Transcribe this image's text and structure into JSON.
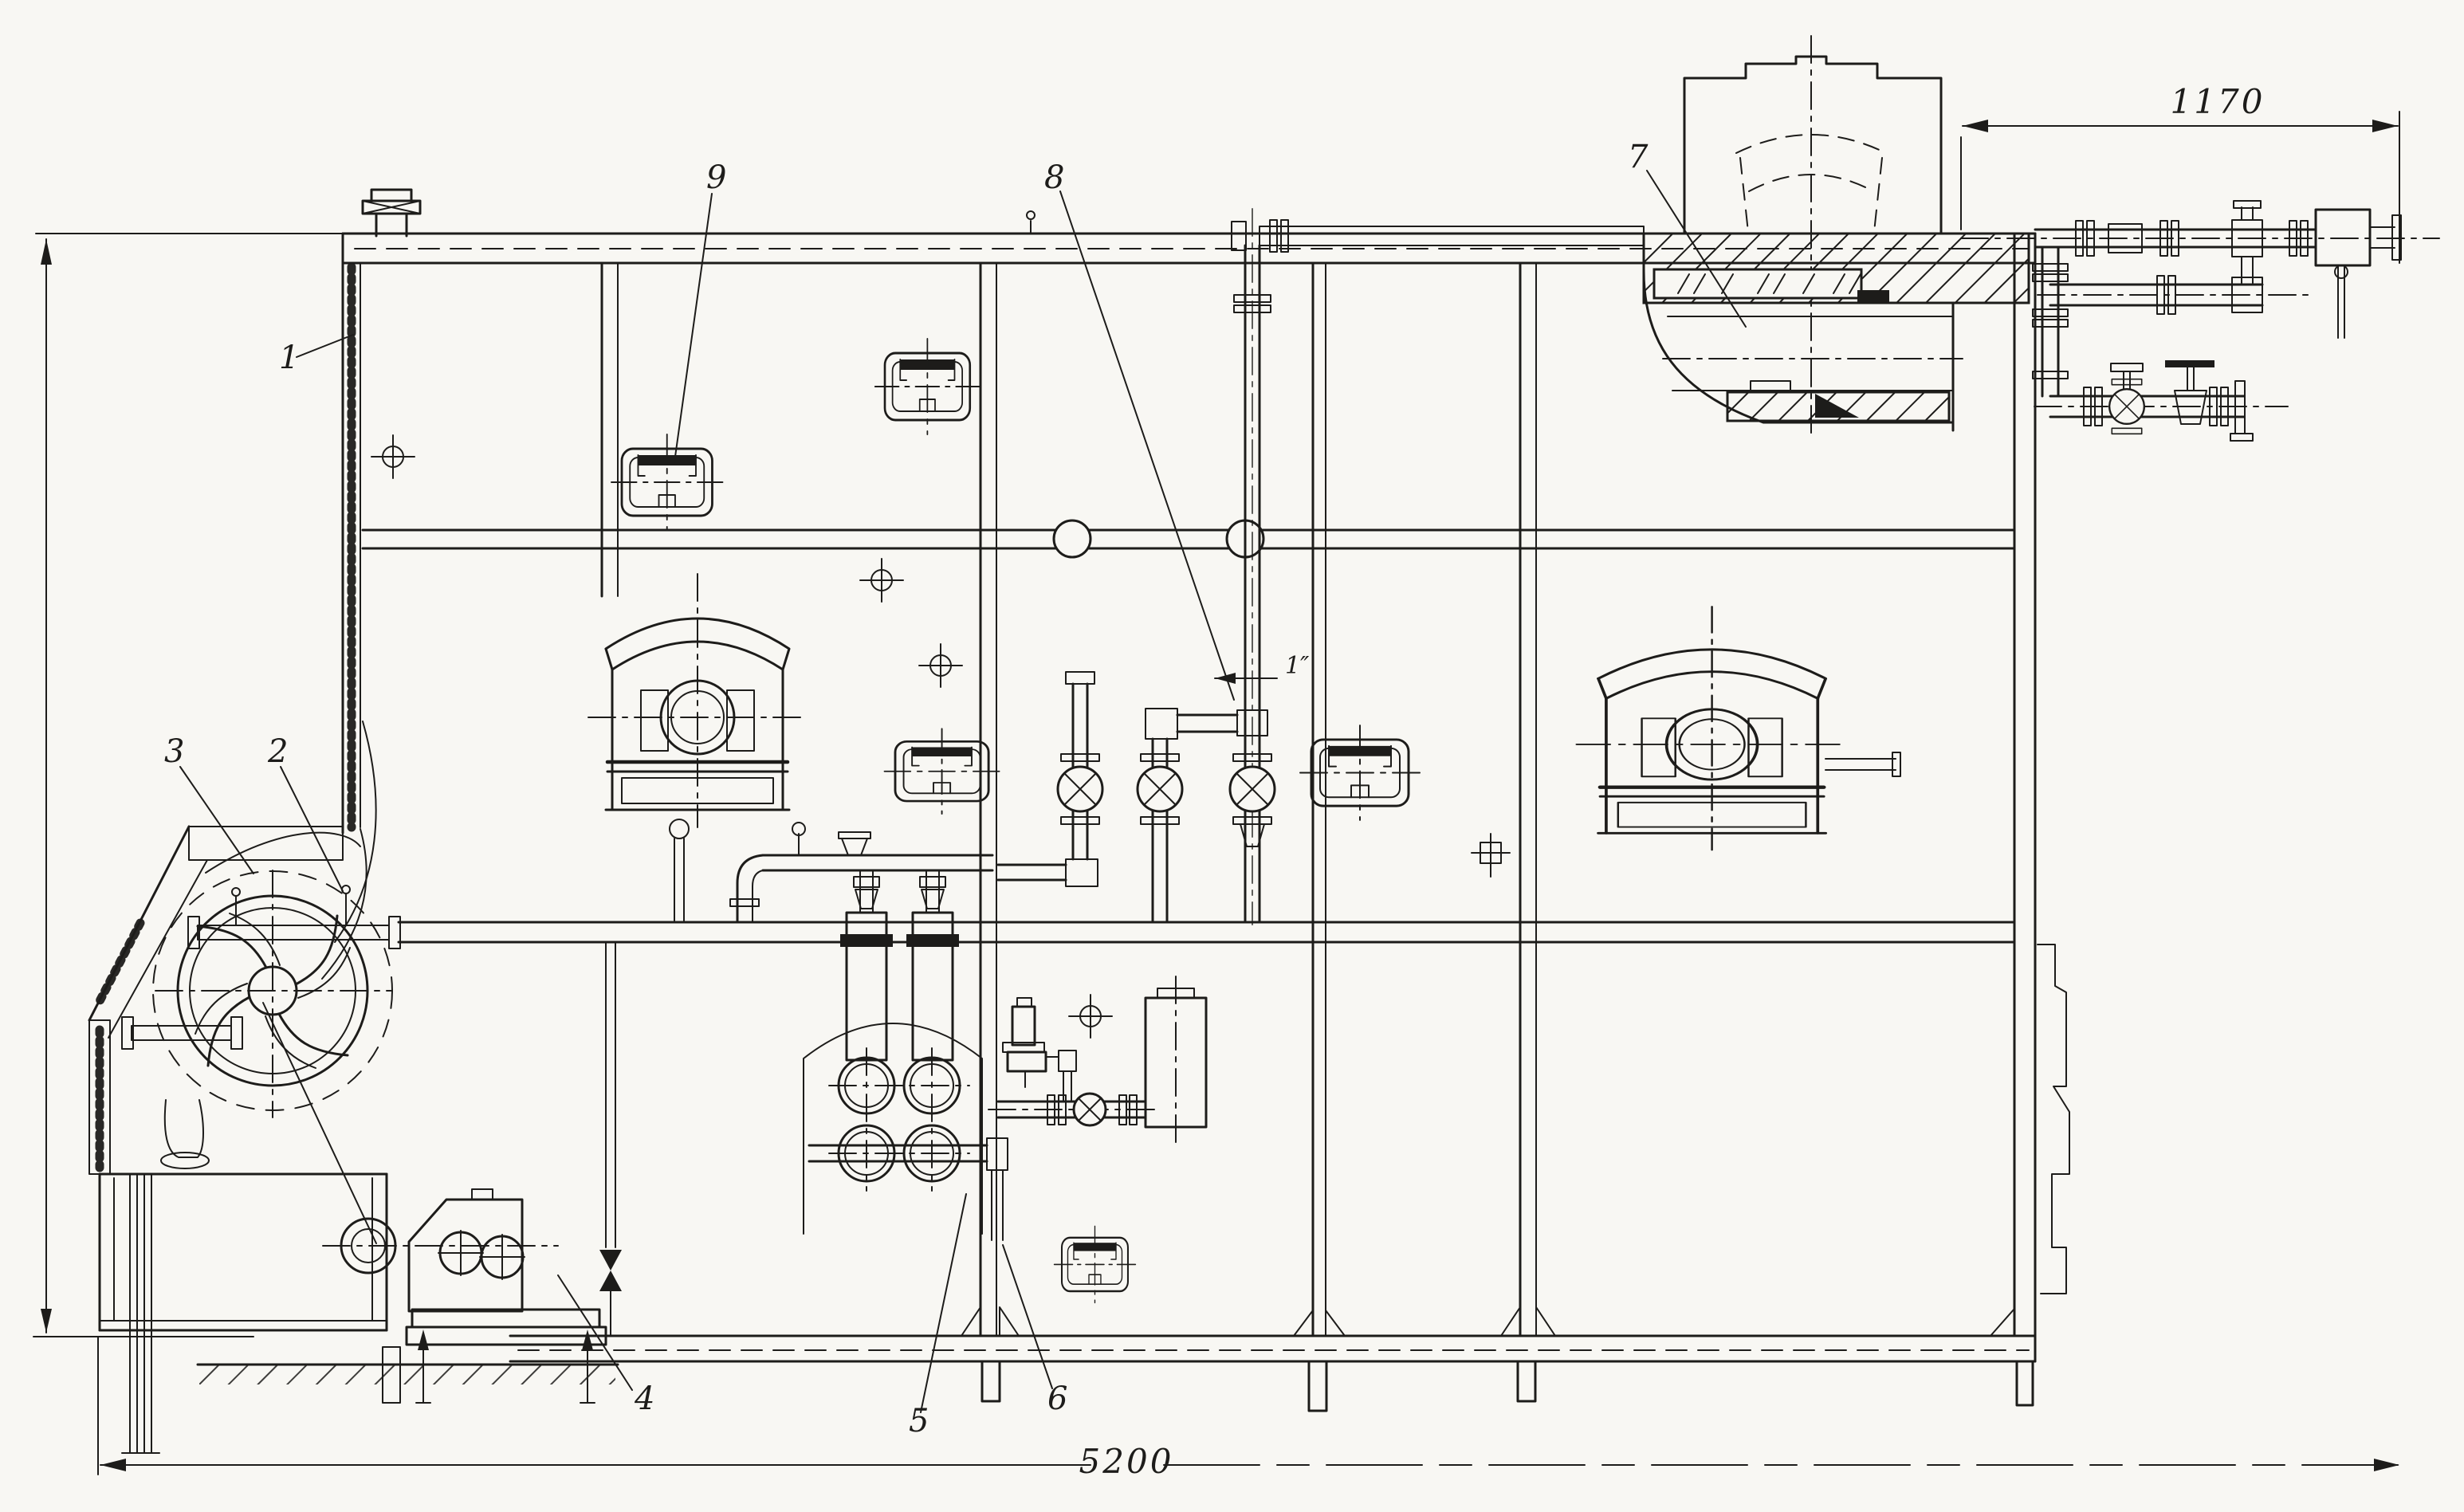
{
  "palette": {
    "paper": "#f8f7f3",
    "ink": "#1d1c1a"
  },
  "drawing": {
    "type": "sectional technical drawing",
    "callouts": [
      {
        "label": "1"
      },
      {
        "label": "2"
      },
      {
        "label": "3"
      },
      {
        "label": "4"
      },
      {
        "label": "5"
      },
      {
        "label": "6"
      },
      {
        "label": "7"
      },
      {
        "label": "8"
      },
      {
        "label": "9"
      }
    ],
    "dimensions": {
      "upper_right_width": "1170",
      "overall_width": "5200"
    },
    "pipe_size_label": "1″"
  }
}
